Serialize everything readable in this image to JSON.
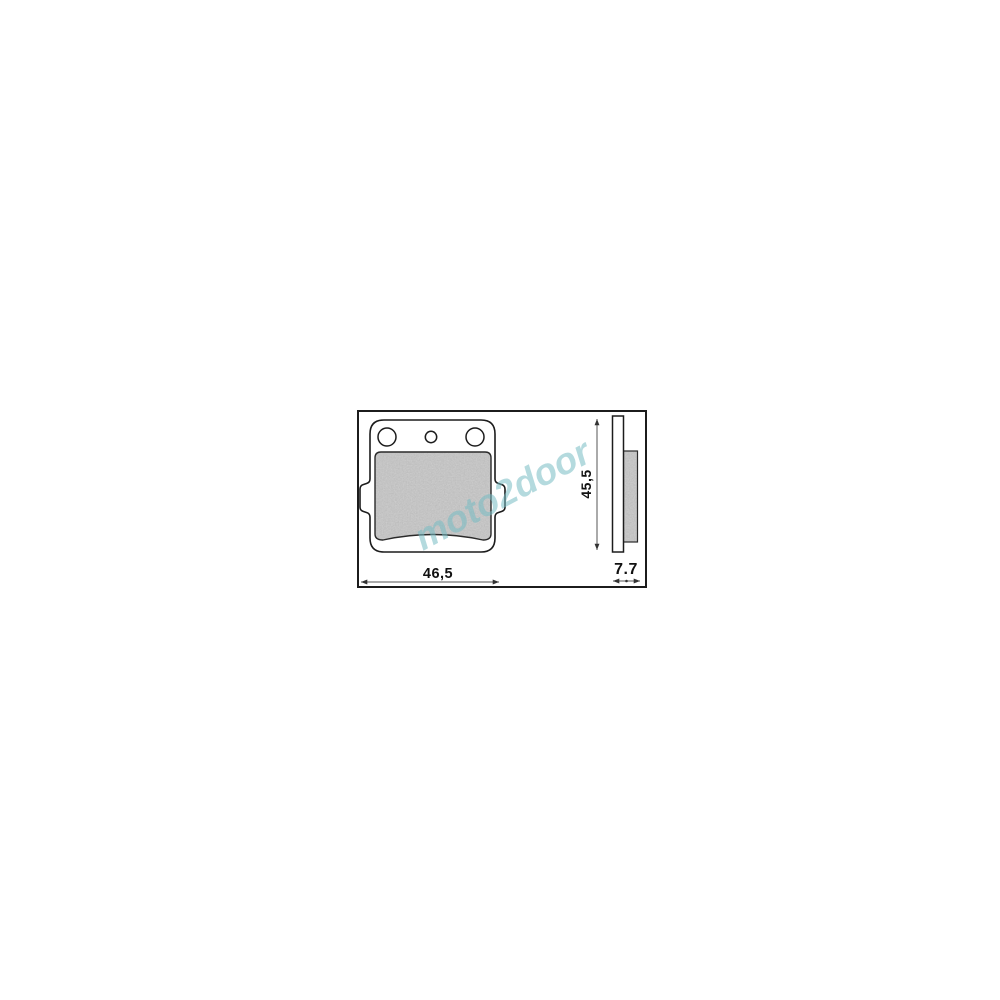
{
  "page": {
    "background_color": "#ffffff"
  },
  "product_drawing": {
    "subject": "brake-pad-technical-drawing",
    "watermark_text": "moto2door",
    "dimensions": {
      "width_label": "46,5",
      "height_label": "45,5",
      "thickness_label": "7.7"
    },
    "colors": {
      "outline": "#1c1c1c",
      "friction_material_fill": "#cbcbcb",
      "dimension_line": "#555555",
      "watermark": "#76bcc2",
      "frame_border": "#1c1c1c"
    }
  }
}
